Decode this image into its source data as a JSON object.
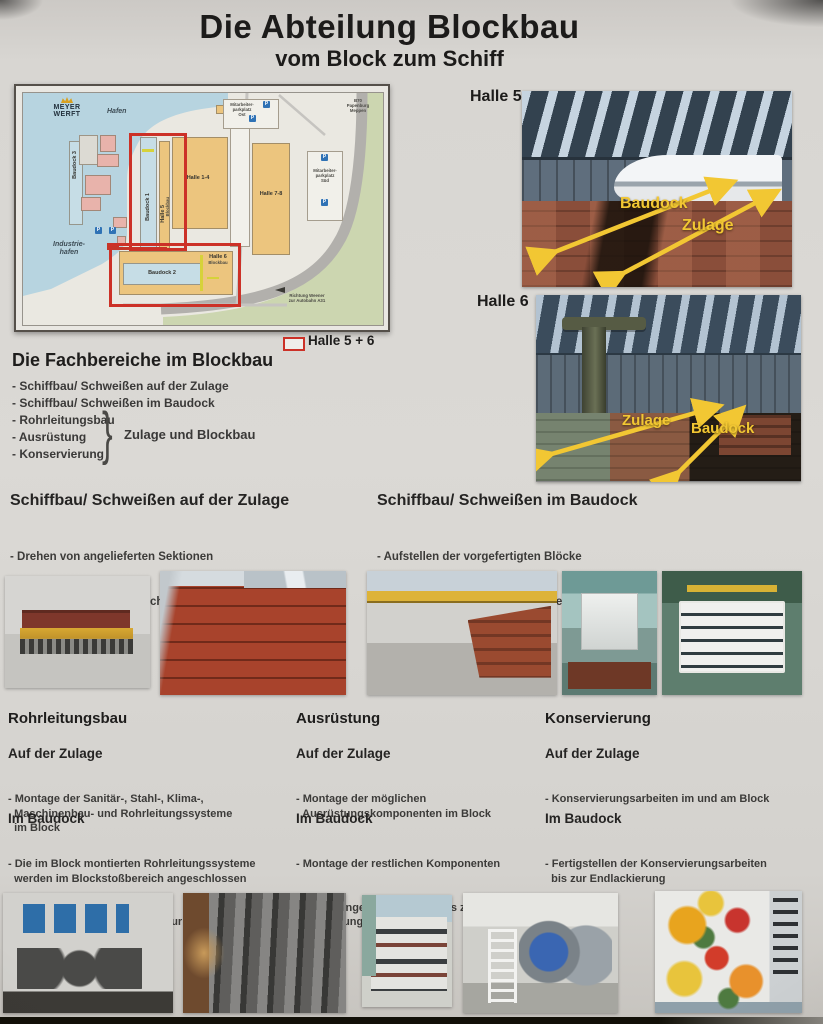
{
  "poster": {
    "title": "Die Abteilung Blockbau",
    "subtitle": "vom Block zum Schiff"
  },
  "map": {
    "logo": "MEYER WERFT",
    "labels": {
      "hafen": "Hafen",
      "industriehafen": "Industrie-\nhafen",
      "baudock3": "Baudock 3",
      "baudock1": "Baudock 1",
      "baudock2": "Baudock 2",
      "halle5": "Halle 5",
      "halle5_sub": "Blockbau",
      "halle6": "Halle 6",
      "halle6_sub": "Blockbau",
      "halle14": "Halle 1-4",
      "halle78": "Halle 7-8",
      "parkplatz_ost": "Mitarbeiter-\nparkplatz\nOst",
      "parkplatz_sued": "Mitarbeiter-\nparkplatz\nSüd",
      "b70": "B70\nPapenburg\nMeppen",
      "richtung": "Richtung Weener\nzur Autobahn A31",
      "parking_symbol": "P"
    },
    "legend": {
      "label": "Halle 5 + 6"
    }
  },
  "halls": {
    "halle5": {
      "label": "Halle 5",
      "anno_baudock": "Baudock",
      "anno_zulage": "Zulage"
    },
    "halle6": {
      "label": "Halle 6",
      "anno_zulage": "Zulage",
      "anno_baudock": "Baudock"
    }
  },
  "fachbereiche": {
    "heading": "Die Fachbereiche im Blockbau",
    "items": [
      "- Schiffbau/ Schweißen auf der Zulage",
      "- Schiffbau/ Schweißen im Baudock",
      "- Rohrleitungsbau",
      "- Ausrüstung",
      "- Konservierung"
    ],
    "brace_label": "Zulage und Blockbau"
  },
  "sections": {
    "zulage": {
      "heading": "Schiffbau/ Schweißen auf der Zulage",
      "bullets": [
        "- Drehen von angelieferten Sektionen",
        "- Zusammenbau und Verschweißen der\n  Sektionen zum Block"
      ]
    },
    "baudock": {
      "heading": "Schiffbau/ Schweißen im Baudock",
      "bullets": [
        "- Aufstellen der vorgefertigten Blöcke",
        "- Zusammenbau und Verschweißen der\n  Blöcke zum Schiffskörper"
      ]
    }
  },
  "columns": [
    {
      "title": "Rohrleitungsbau",
      "zulage_heading": "Auf der Zulage",
      "zulage_items": [
        "- Montage der Sanitär-, Stahl-, Klima-,\n  Maschinenbau- und Rohrleitungssysteme\n  im Block"
      ],
      "baudock_heading": "Im Baudock",
      "baudock_items": [
        "- Die im Block montierten Rohrleitungssysteme\n  werden im Blockstoßbereich angeschlossen",
        "- Betreuung aller Systeme bis zur Ablieferung\n  des Schiffes"
      ]
    },
    {
      "title": "Ausrüstung",
      "zulage_heading": "Auf der Zulage",
      "zulage_items": [
        "- Montage der möglichen\n  Ausrüstungskomponenten im Block"
      ],
      "baudock_heading": "Im Baudock",
      "baudock_items": [
        "- Montage der restlichen Komponenten",
        "- Erprobungen der Anlagen bis zur\n  Ablieferung des Schiffes"
      ]
    },
    {
      "title": "Konservierung",
      "zulage_heading": "Auf der Zulage",
      "zulage_items": [
        "- Konservierungsarbeiten im und am Block"
      ],
      "baudock_heading": "Im Baudock",
      "baudock_items": [
        "- Fertigstellen der Konservierungsarbeiten\n  bis zur Endlackierung"
      ]
    }
  ],
  "colors": {
    "highlight_red": "#cc3127",
    "annotation_yellow": "#f2c733"
  }
}
